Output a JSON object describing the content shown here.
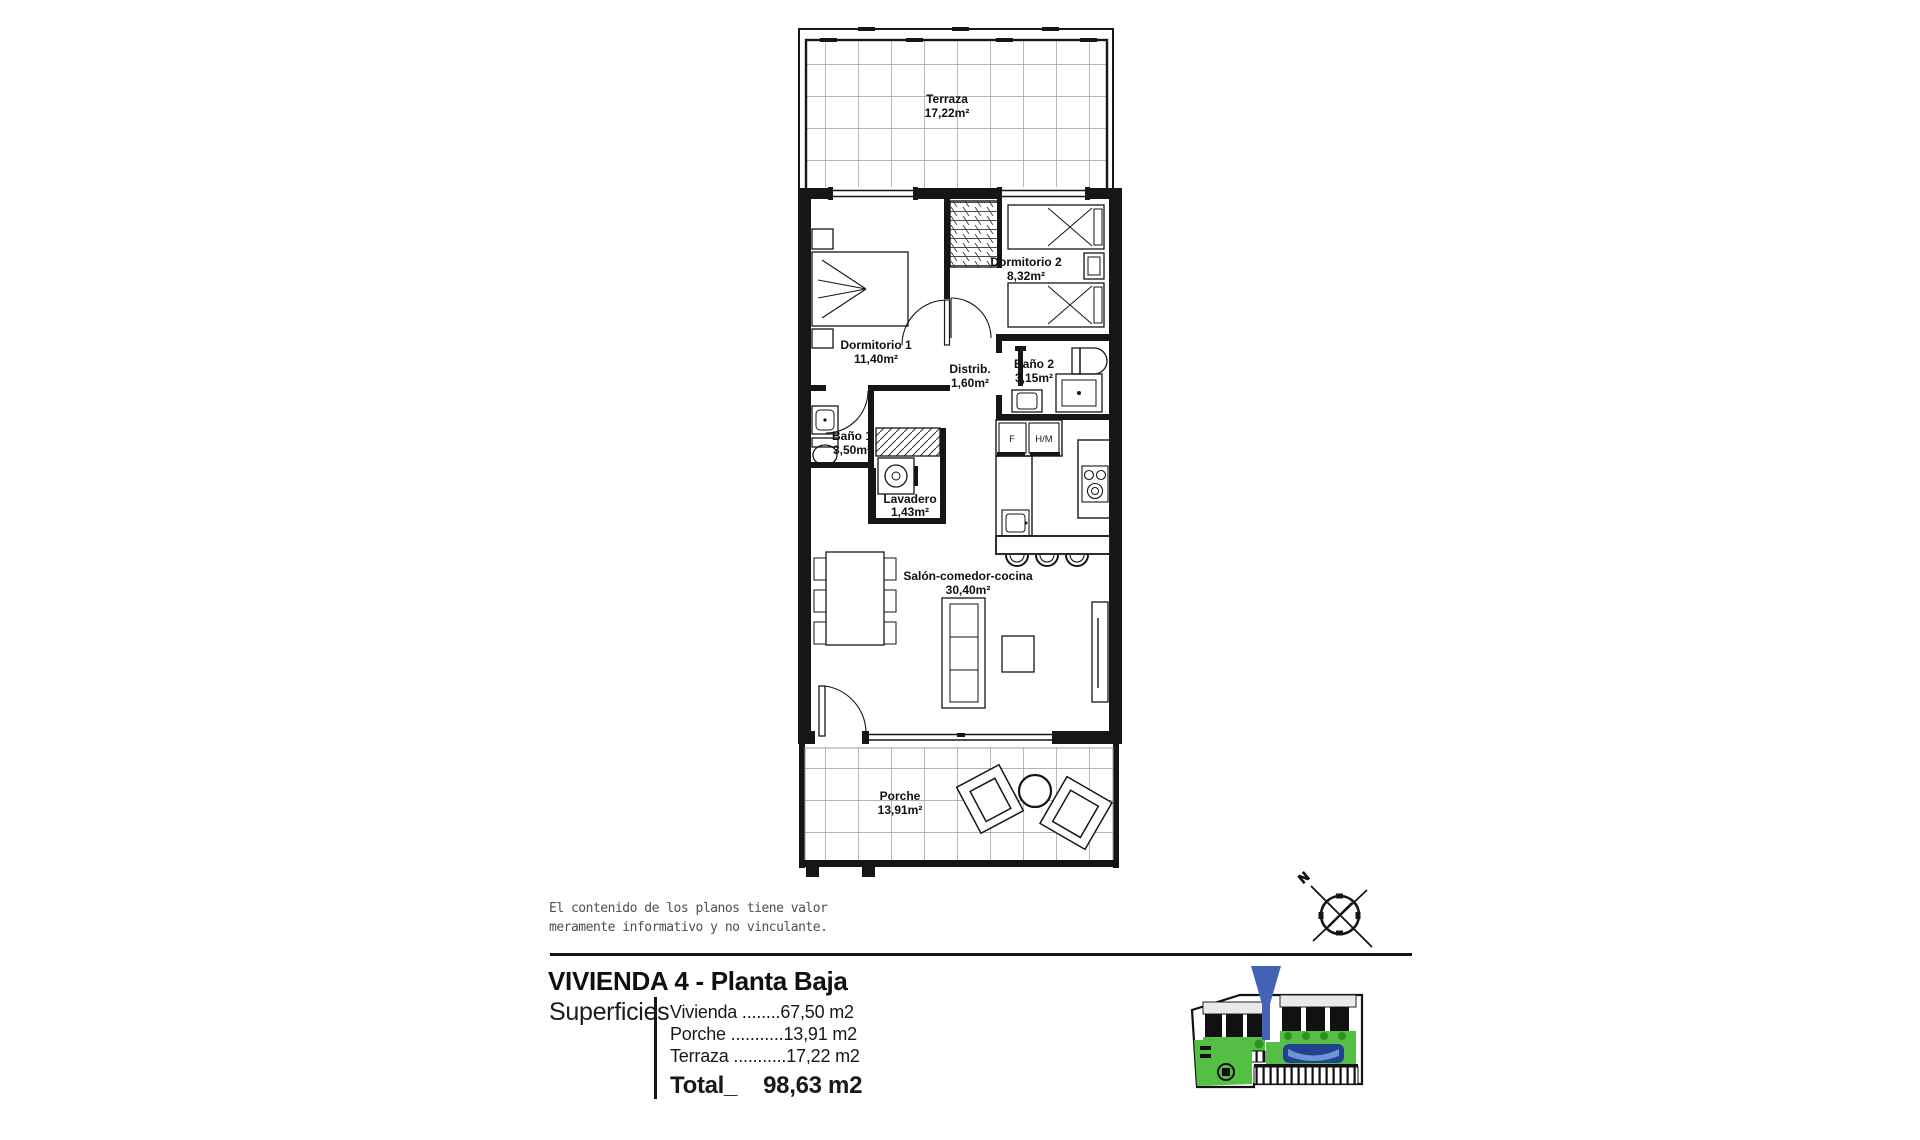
{
  "plan": {
    "rooms": [
      {
        "name": "Terraza",
        "area": "17,22m²"
      },
      {
        "name": "Dormitorio 2",
        "area": "8,32m²"
      },
      {
        "name": "Dormitorio 1",
        "area": "11,40m²"
      },
      {
        "name": "Distrib.",
        "area": "1,60m²"
      },
      {
        "name": "Baño 2",
        "area": "3,15m²"
      },
      {
        "name": "Baño 1",
        "area": "3,50m²"
      },
      {
        "name": "Lavadero",
        "area": "1,43m²"
      },
      {
        "name": "Salón-comedor-cocina",
        "area": "30,40m²"
      },
      {
        "name": "Porche",
        "area": "13,91m²"
      }
    ],
    "appliance_labels": {
      "fridge": "F",
      "oven_micro": "H/M"
    }
  },
  "compass": {
    "north": "N"
  },
  "disclaimer": {
    "line1": "El contenido de los planos tiene valor",
    "line2": "meramente informativo y no vinculante."
  },
  "title": "VIVIENDA 4 - Planta Baja",
  "superficies": {
    "heading": "Superficies",
    "items": [
      {
        "label": "Vivienda",
        "dots": " ........",
        "value": "67,50 m2"
      },
      {
        "label": "Porche",
        "dots": " ...........",
        "value": "13,91 m2"
      },
      {
        "label": "Terraza",
        "dots": " ...........",
        "value": "17,22 m2"
      }
    ],
    "total_label": "Total_",
    "total_value": "98,63 m2"
  },
  "colors": {
    "wall_black": "#161616",
    "tile_gray": "#9b9b9b",
    "site_green": "#54bf44",
    "pool_blue": "#24418f",
    "marker_blue": "#4363b4"
  }
}
